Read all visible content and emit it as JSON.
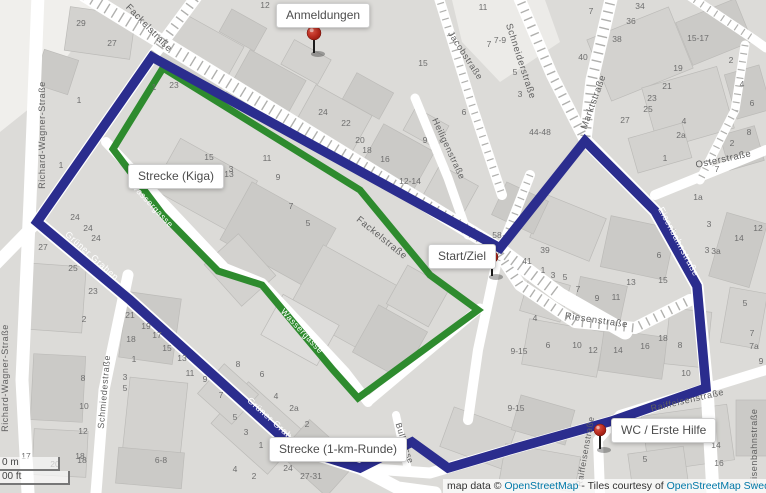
{
  "tooltips": {
    "anmeldungen": "Anmeldungen",
    "strecke_kiga": "Strecke (Kiga)",
    "start_ziel": "Start/Ziel",
    "strecke_1km": "Strecke (1-km-Runde)",
    "wc_erste_hilfe": "WC / Erste Hilfe"
  },
  "scale": {
    "metric": "0 m",
    "imperial": "00 ft"
  },
  "attribution": {
    "prefix": "map data © ",
    "osm_link": "OpenStreetMap",
    "middle": " - Tiles courtesy of ",
    "sweden_link": "OpenStreetMap Sweden",
    "dash1": " — ",
    "uber_link": "Uber",
    "dash2": " — S"
  },
  "colors": {
    "route_blue": "#2b2d8e",
    "route_green": "#2e8b2e",
    "pin_red": "#b5281c",
    "link_blue": "#0078a8",
    "street_label": "#5f5f5f",
    "house_number": "#6e6e6e"
  },
  "street_labels": [
    {
      "t": "Fackelstraße",
      "x": 147,
      "y": 30,
      "r": 46,
      "w": 0,
      "s": 9.5
    },
    {
      "t": "Fackelstraße",
      "x": 380,
      "y": 240,
      "r": 39,
      "w": 0,
      "s": 9.5
    },
    {
      "t": "Richard-Wagner-Straße",
      "x": 45,
      "y": 135,
      "r": -90,
      "w": 0,
      "s": 9
    },
    {
      "t": "Richard-Wagner-Straße",
      "x": 8,
      "y": 378,
      "r": -90,
      "w": 0,
      "s": 9
    },
    {
      "t": "Schmiedestraße",
      "x": 107,
      "y": 392,
      "r": -85,
      "w": 0,
      "s": 9
    },
    {
      "t": "Jacobstraße",
      "x": 463,
      "y": 57,
      "r": 57,
      "w": 0,
      "s": 9
    },
    {
      "t": "Schneiderstraße",
      "x": 518,
      "y": 62,
      "r": 72,
      "w": 0,
      "s": 9.5
    },
    {
      "t": "Heiligenstraße",
      "x": 446,
      "y": 150,
      "r": 65,
      "w": 0,
      "s": 9
    },
    {
      "t": "Marktstraße",
      "x": 596,
      "y": 103,
      "r": -70,
      "w": 0,
      "s": 9.5
    },
    {
      "t": "Osterstraße",
      "x": 724,
      "y": 162,
      "r": -12,
      "w": 0,
      "s": 9.5
    },
    {
      "t": "Riesenstraße",
      "x": 596,
      "y": 323,
      "r": 8,
      "w": 0,
      "s": 9.5
    },
    {
      "t": "Eisenbahnstraße",
      "x": 676,
      "y": 243,
      "r": 62,
      "w": 1,
      "s": 9
    },
    {
      "t": "Grüner Graben",
      "x": 90,
      "y": 258,
      "r": 42,
      "w": 1,
      "s": 9
    },
    {
      "t": "Grüner Graben",
      "x": 272,
      "y": 424,
      "r": 42,
      "w": 1,
      "s": 9
    },
    {
      "t": "Wassergasse",
      "x": 150,
      "y": 207,
      "r": 47,
      "w": 1,
      "s": 8.5
    },
    {
      "t": "Wassergasse",
      "x": 300,
      "y": 333,
      "r": 47,
      "w": 1,
      "s": 8.5
    },
    {
      "t": "Bullgasse",
      "x": 402,
      "y": 444,
      "r": 72,
      "w": 0,
      "s": 8.5
    },
    {
      "t": "Raiffeisenstraße",
      "x": 688,
      "y": 403,
      "r": -13,
      "w": 0,
      "s": 9
    },
    {
      "t": "Raiffeisenstraße",
      "x": 588,
      "y": 452,
      "r": -80,
      "w": 0,
      "s": 8.5
    },
    {
      "t": "Eisenbahnstraße",
      "x": 757,
      "y": 447,
      "r": -90,
      "w": 0,
      "s": 9
    }
  ],
  "house_numbers": [
    [
      "29",
      81,
      26
    ],
    [
      "27",
      112,
      46
    ],
    [
      "12",
      265,
      8
    ],
    [
      "1",
      79,
      103
    ],
    [
      "23",
      174,
      88
    ],
    [
      "1",
      154,
      90
    ],
    [
      "11",
      483,
      10
    ],
    [
      "7-9",
      500,
      43
    ],
    [
      "7",
      489,
      47
    ],
    [
      "5",
      515,
      75
    ],
    [
      "3",
      520,
      97
    ],
    [
      "6",
      464,
      115
    ],
    [
      "15",
      423,
      66
    ],
    [
      "40",
      583,
      60
    ],
    [
      "44-48",
      540,
      135
    ],
    [
      "7",
      591,
      14
    ],
    [
      "34",
      640,
      9
    ],
    [
      "36",
      631,
      24
    ],
    [
      "38",
      617,
      42
    ],
    [
      "15-17",
      698,
      41
    ],
    [
      "19",
      678,
      71
    ],
    [
      "2",
      731,
      63
    ],
    [
      "21",
      667,
      89
    ],
    [
      "23",
      652,
      101
    ],
    [
      "25",
      648,
      112
    ],
    [
      "4",
      742,
      87
    ],
    [
      "6",
      752,
      106
    ],
    [
      "27",
      625,
      123
    ],
    [
      "4",
      684,
      124
    ],
    [
      "2a",
      681,
      138
    ],
    [
      "8",
      749,
      135
    ],
    [
      "2",
      732,
      146
    ],
    [
      "1",
      665,
      161
    ],
    [
      "7",
      717,
      172
    ],
    [
      "24",
      323,
      115
    ],
    [
      "22",
      346,
      126
    ],
    [
      "20",
      360,
      143
    ],
    [
      "18",
      367,
      153
    ],
    [
      "16",
      385,
      162
    ],
    [
      "9",
      425,
      143
    ],
    [
      "12-14",
      410,
      184
    ],
    [
      "11",
      267,
      161
    ],
    [
      "9",
      278,
      180
    ],
    [
      "3",
      231,
      172
    ],
    [
      "7",
      291,
      209
    ],
    [
      "5",
      308,
      226
    ],
    [
      "15",
      209,
      160
    ],
    [
      "13",
      229,
      177
    ],
    [
      "1",
      61,
      168
    ],
    [
      "24",
      75,
      220
    ],
    [
      "24",
      88,
      231
    ],
    [
      "24",
      96,
      241
    ],
    [
      "27",
      43,
      250
    ],
    [
      "25",
      73,
      271
    ],
    [
      "23",
      93,
      294
    ],
    [
      "2",
      84,
      322
    ],
    [
      "21",
      130,
      318
    ],
    [
      "19",
      146,
      329
    ],
    [
      "17",
      157,
      338
    ],
    [
      "18",
      131,
      342
    ],
    [
      "15",
      167,
      351
    ],
    [
      "13",
      182,
      361
    ],
    [
      "11",
      190,
      376
    ],
    [
      "9",
      205,
      382
    ],
    [
      "1",
      134,
      362
    ],
    [
      "3",
      125,
      380
    ],
    [
      "5",
      125,
      391
    ],
    [
      "8",
      83,
      381
    ],
    [
      "10",
      84,
      409
    ],
    [
      "12",
      83,
      434
    ],
    [
      "18",
      82,
      463
    ],
    [
      "6-8",
      161,
      463
    ],
    [
      "8",
      238,
      367
    ],
    [
      "6",
      262,
      377
    ],
    [
      "4",
      276,
      399
    ],
    [
      "2a",
      294,
      411
    ],
    [
      "2",
      307,
      427
    ],
    [
      "7",
      221,
      398
    ],
    [
      "5",
      235,
      420
    ],
    [
      "3",
      246,
      435
    ],
    [
      "1",
      261,
      448
    ],
    [
      "4",
      235,
      472
    ],
    [
      "2",
      254,
      479
    ],
    [
      "24",
      288,
      471
    ],
    [
      "27-31",
      311,
      479
    ],
    [
      "58",
      497,
      238
    ],
    [
      "39",
      545,
      253
    ],
    [
      "41",
      527,
      264
    ],
    [
      "1",
      543,
      273
    ],
    [
      "3",
      553,
      278
    ],
    [
      "5",
      565,
      280
    ],
    [
      "7",
      578,
      292
    ],
    [
      "9",
      597,
      301
    ],
    [
      "11",
      616,
      300
    ],
    [
      "13",
      631,
      285
    ],
    [
      "15",
      663,
      283
    ],
    [
      "6",
      548,
      348
    ],
    [
      "4",
      535,
      321
    ],
    [
      "10",
      577,
      348
    ],
    [
      "12",
      593,
      353
    ],
    [
      "14",
      618,
      353
    ],
    [
      "16",
      645,
      349
    ],
    [
      "18",
      663,
      341
    ],
    [
      "8",
      680,
      348
    ],
    [
      "10",
      686,
      376
    ],
    [
      "3",
      707,
      253
    ],
    [
      "3a",
      716,
      254
    ],
    [
      "5",
      745,
      306
    ],
    [
      "7",
      752,
      336
    ],
    [
      "7a",
      754,
      349
    ],
    [
      "9",
      761,
      364
    ],
    [
      "1a",
      698,
      200
    ],
    [
      "3",
      709,
      227
    ],
    [
      "12",
      758,
      231
    ],
    [
      "14",
      739,
      241
    ],
    [
      "6",
      659,
      258
    ],
    [
      "9-15",
      519,
      354
    ],
    [
      "9-15",
      516,
      411
    ],
    [
      "12",
      698,
      428
    ],
    [
      "14",
      716,
      448
    ],
    [
      "5",
      645,
      462
    ],
    [
      "16",
      719,
      466
    ],
    [
      "17",
      26,
      459
    ],
    [
      "20",
      55,
      467
    ],
    [
      "18",
      80,
      459
    ]
  ]
}
